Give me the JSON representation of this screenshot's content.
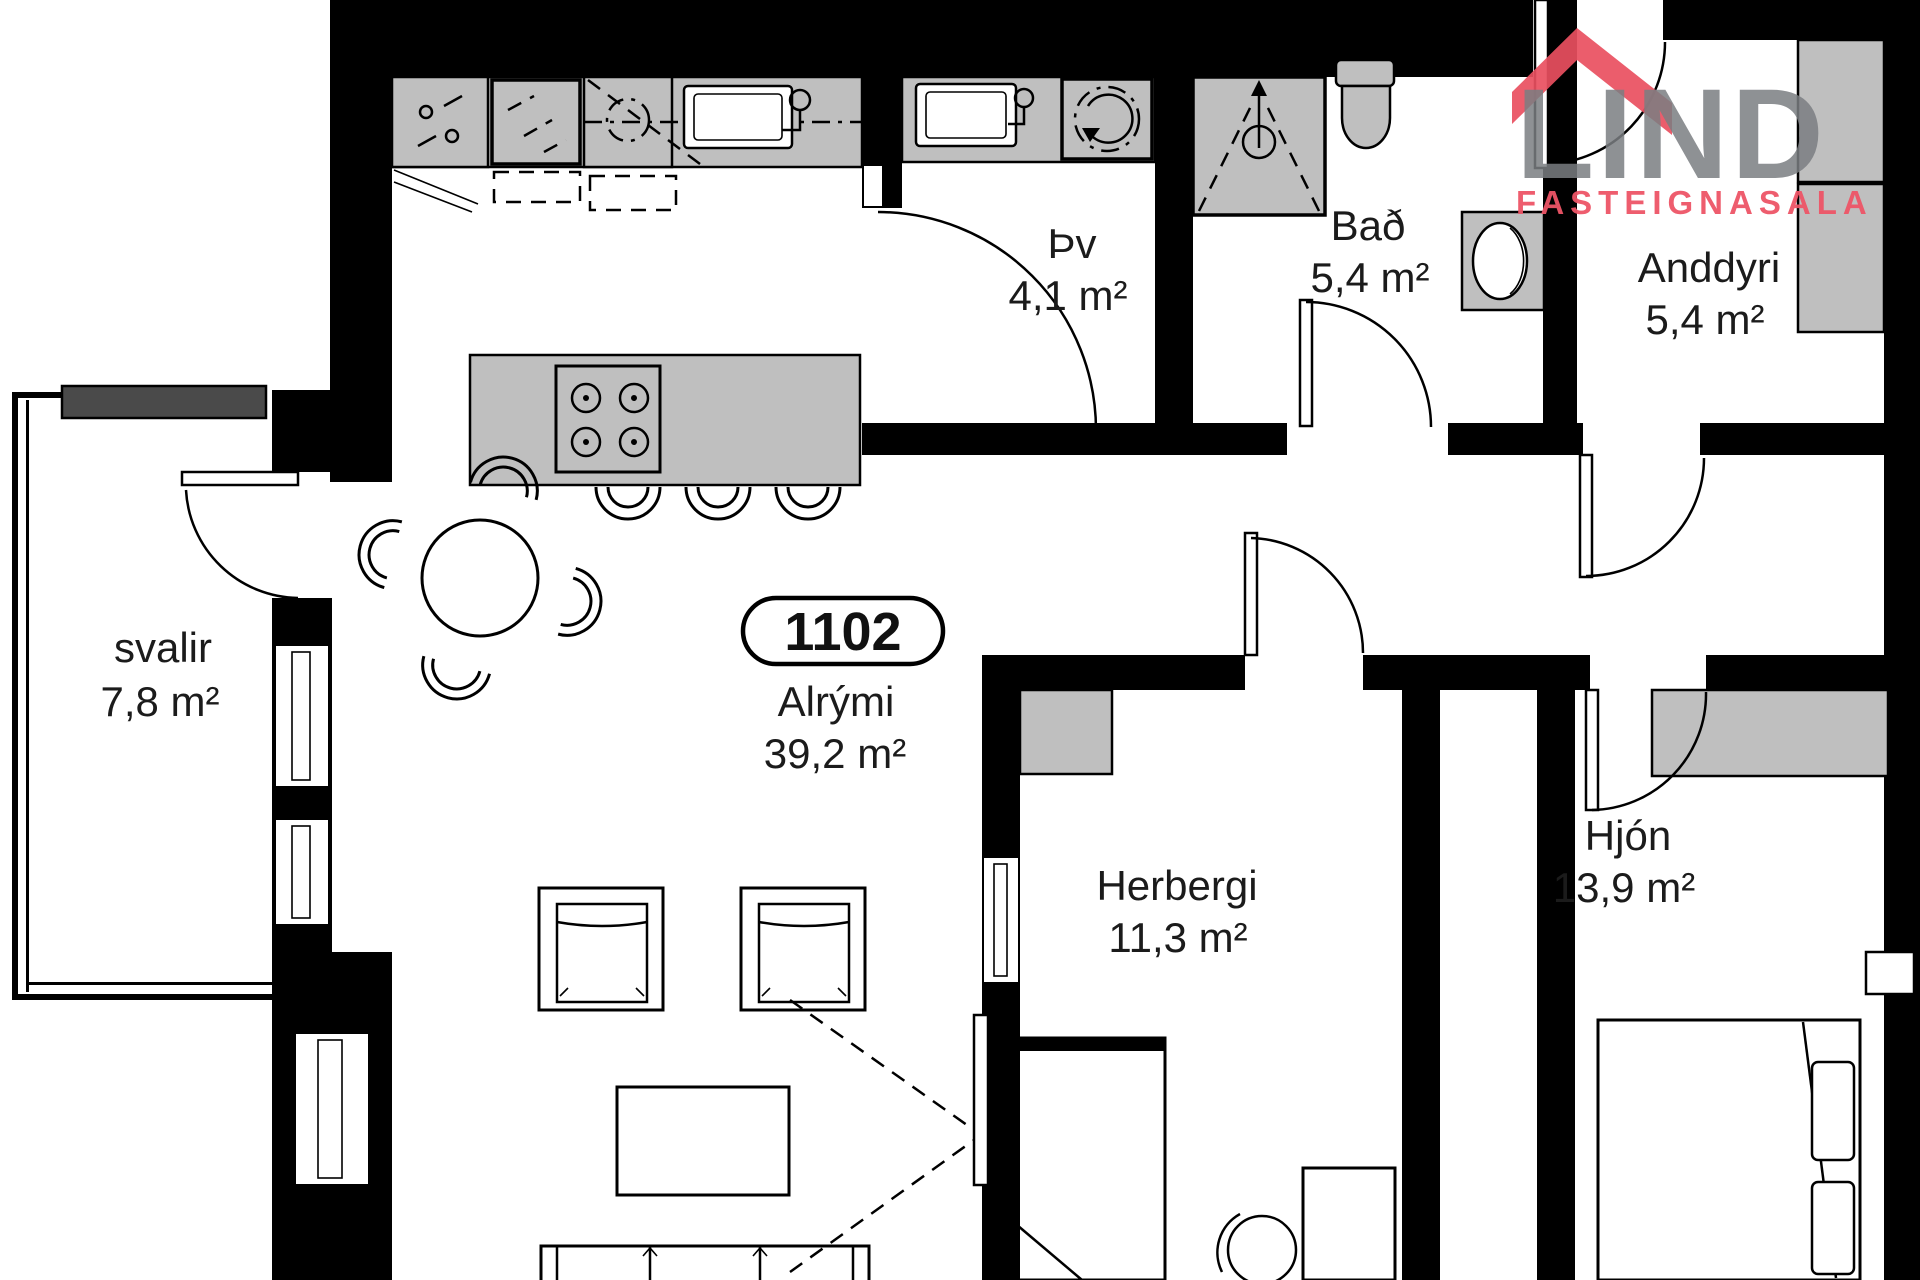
{
  "branding": {
    "name": "LIND",
    "subtitle": "FASTEIGNASALA",
    "name_color": "#7b7e82",
    "subtitle_color": "#ee5567",
    "roof_color": "#e94f5f"
  },
  "unit": {
    "number": "1102"
  },
  "colors": {
    "wall": "#000000",
    "fixture_fill": "#bfbfbf",
    "background": "#ffffff",
    "label_text": "#1b1b1b"
  },
  "rooms": [
    {
      "id": "svalir",
      "name": "svalir",
      "area": "7,8 m²"
    },
    {
      "id": "thv",
      "name": "Þv",
      "area": "4,1 m²"
    },
    {
      "id": "bad",
      "name": "Bað",
      "area": "5,4 m²"
    },
    {
      "id": "anddyri",
      "name": "Anddyri",
      "area": "5,4 m²"
    },
    {
      "id": "alrymi",
      "name": "Alrými",
      "area": "39,2 m²"
    },
    {
      "id": "herbergi",
      "name": "Herbergi",
      "area": "11,3 m²"
    },
    {
      "id": "hjon",
      "name": "Hjón",
      "area": "13,9 m²"
    }
  ]
}
